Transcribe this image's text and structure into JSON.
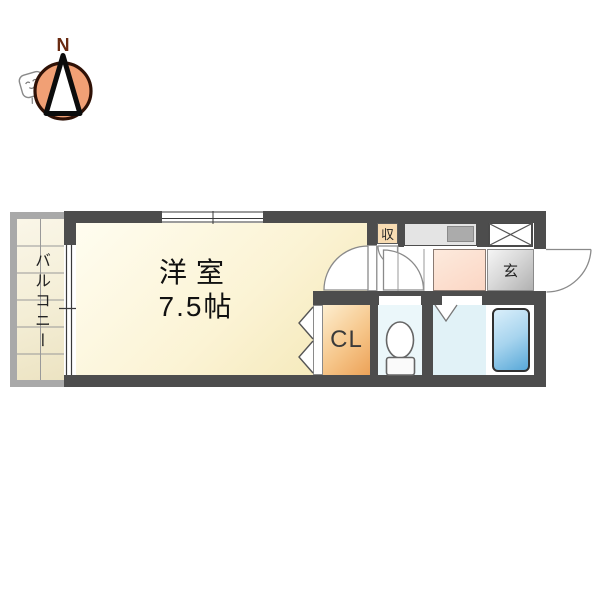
{
  "compass": {
    "north": "N"
  },
  "plan": {
    "balcony": "バルコニー",
    "main_room_name": "洋室",
    "main_room_size": "7.5帖",
    "closet": "CL",
    "storage": "収",
    "entrance": "玄"
  },
  "colors": {
    "wall": "#4d4d4d",
    "main_room_fill": "#f9efc6",
    "closet_fill": "#eca258",
    "kitchen_floor_fill": "#fbd6c4",
    "genkan_fill": "#c7c7c7",
    "bathtub_fill": "#58a8d8",
    "toilet_room_fill": "#ebf7fa",
    "bathroom_fill": "#e1f2f7",
    "balcony_floor_fill": "#f4eed6",
    "storage_fill": "#f8dcb2",
    "compass_circle_fill": "#f1a075",
    "north_letter_color": "#692a11"
  }
}
